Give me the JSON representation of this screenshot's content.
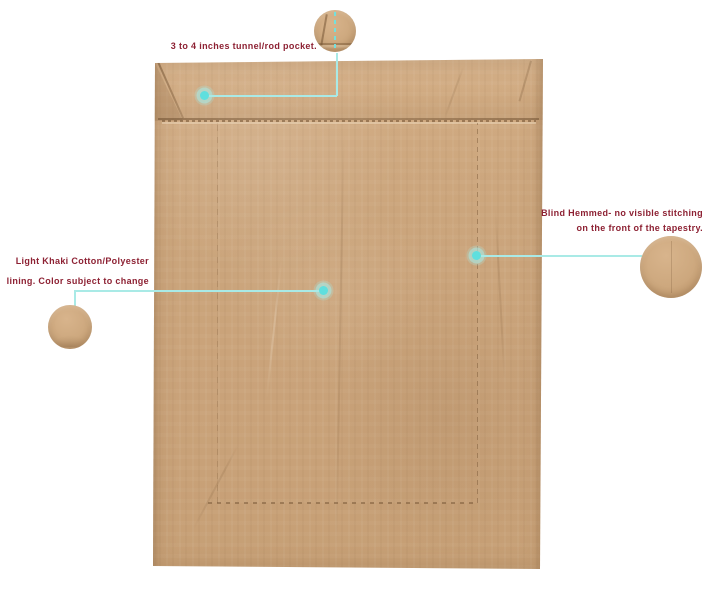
{
  "colors": {
    "background": "#ffffff",
    "fabric": "#cba57c",
    "fabric_light": "#d2ac83",
    "accent_teal": "#5fdfde",
    "teal_line": "#a9eae6",
    "label_text": "#8d2133"
  },
  "annotations": {
    "rod_pocket": {
      "label": "3 to 4 inches tunnel/rod pocket."
    },
    "blind_hem": {
      "line1": "Blind Hemmed- no visible stitching",
      "line2": "on the front of the tapestry."
    },
    "lining": {
      "line1": "Light Khaki Cotton/Polyester",
      "line2": "lining. Color subject to change"
    }
  }
}
